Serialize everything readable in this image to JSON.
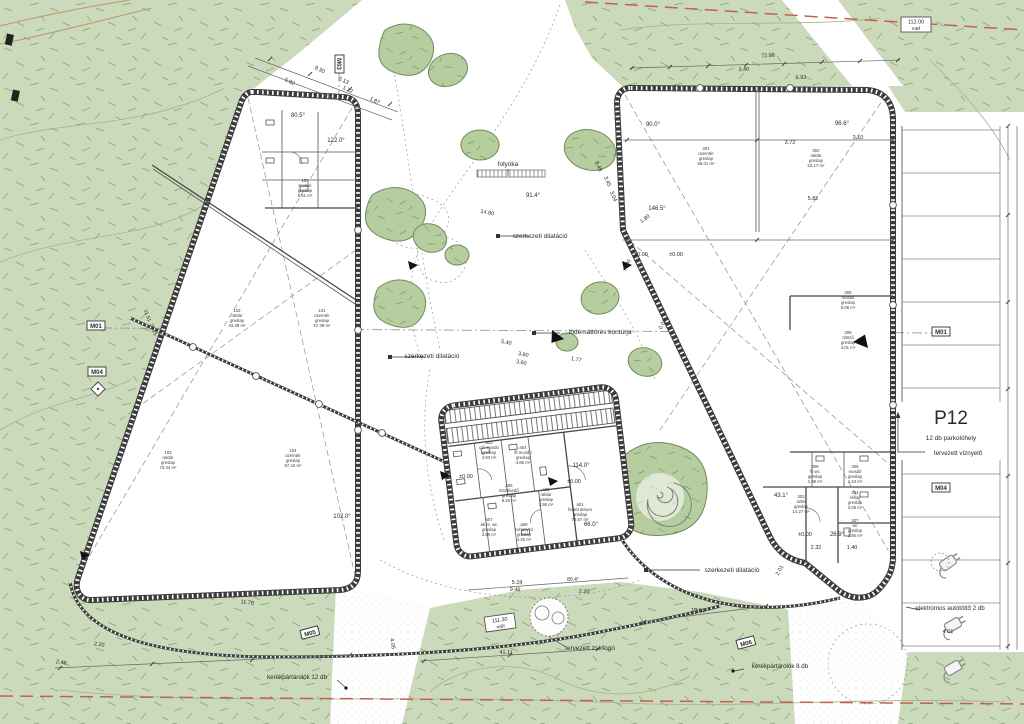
{
  "drawing_type": "architectural site plan",
  "colors": {
    "vegetation": "#cbdaba",
    "tree": "#b5cd9f",
    "vegetation_line": "#86a374",
    "wall": "#3c3c3c",
    "boundary_red": "#c4614d",
    "utility_tan": "#b99d6d"
  },
  "parking": {
    "code": "P12",
    "subtitle": "12 db parkolóhely",
    "stalls": 12,
    "x": 951,
    "y": 424
  },
  "markers": [
    {
      "label": "M01",
      "x": 96,
      "y": 326,
      "r": 0
    },
    {
      "label": "M04",
      "x": 97,
      "y": 372,
      "r": 0
    },
    {
      "label": "M03",
      "x": 339,
      "y": 64,
      "r": 90
    },
    {
      "label": "M01",
      "x": 941,
      "y": 332,
      "r": 0
    },
    {
      "label": "M04",
      "x": 941,
      "y": 488,
      "r": 0
    },
    {
      "label": "M05",
      "x": 310,
      "y": 633,
      "r": -15
    },
    {
      "label": "M06",
      "x": 746,
      "y": 643,
      "r": -15
    }
  ],
  "elevation_markers": [
    {
      "value": "112.00",
      "unit": "mBf",
      "x": 916,
      "y": 24,
      "r": 0
    },
    {
      "value": "111.30",
      "unit": "mBf",
      "x": 500,
      "y": 622,
      "r": -8
    }
  ],
  "rooms": [
    {
      "id": "101",
      "name": "üzemtér",
      "finish": "greslap",
      "area": "57.38 m²",
      "x": 322,
      "y": 312
    },
    {
      "id": "102",
      "name": "raktár",
      "finish": "greslap",
      "area": "43.39 m²",
      "x": 237,
      "y": 312
    },
    {
      "id": "103",
      "name": "raktár",
      "finish": "greslap",
      "area": "73.44 m²",
      "x": 168,
      "y": 454
    },
    {
      "id": "104",
      "name": "üzemtér",
      "finish": "greslap",
      "area": "57.42 m²",
      "x": 293,
      "y": 452
    },
    {
      "id": "105",
      "name": "mosdó",
      "finish": "greslap",
      "area": "9.51 m²",
      "x": 305,
      "y": 182
    },
    {
      "id": "301",
      "name": "üzemtér",
      "finish": "greslap",
      "area": "66.01 m²",
      "x": 706,
      "y": 150
    },
    {
      "id": "302",
      "name": "raktár",
      "finish": "greslap",
      "area": "52.17 m²",
      "x": 816,
      "y": 152
    },
    {
      "id": "303",
      "name": "üzlet",
      "finish": "greslap",
      "area": "14.27 m²",
      "x": 801,
      "y": 498
    },
    {
      "id": "304",
      "name": "előtér",
      "finish": "greslap",
      "area": "2.08 m²",
      "x": 855,
      "y": 494
    },
    {
      "id": "305",
      "name": "mosdó",
      "finish": "greslap",
      "area": "1.43 m²",
      "x": 855,
      "y": 468
    },
    {
      "id": "306",
      "name": "ffi wc",
      "finish": "greslap",
      "area": "1.98 m²",
      "x": 815,
      "y": 468
    },
    {
      "id": "307",
      "name": "wc",
      "finish": "greslap",
      "area": "1.56 m²",
      "x": 855,
      "y": 522
    },
    {
      "id": "308",
      "name": "mosdó",
      "finish": "greslap",
      "area": "5.08 m²",
      "x": 848,
      "y": 294
    },
    {
      "id": "309",
      "name": "öltöző",
      "finish": "greslap",
      "area": "4.01 m²",
      "x": 848,
      "y": 334
    },
    {
      "id": "a03",
      "name": "női mosdó",
      "finish": "greslap",
      "area": "4.93 m²",
      "x": 489,
      "y": 444
    },
    {
      "id": "a04",
      "name": "ffi mosdó",
      "finish": "greslap",
      "area": "4.86 m²",
      "x": 523,
      "y": 449
    },
    {
      "id": "a05",
      "name": "közlekedő",
      "finish": "greslap",
      "area": "8.26 m²",
      "x": 509,
      "y": 487
    },
    {
      "id": "a06",
      "name": "raktár",
      "finish": "greslap",
      "area": "2.95 m²",
      "x": 546,
      "y": 491
    },
    {
      "id": "a07",
      "name": "ak.m. wc",
      "finish": "greslap",
      "area": "3.89 m²",
      "x": 489,
      "y": 521
    },
    {
      "id": "a08",
      "name": "zuhanyzó",
      "finish": "greslap",
      "area": "4.25 m²",
      "x": 524,
      "y": 526
    },
    {
      "id": "a01",
      "name": "fedett átrium",
      "finish": "greslap",
      "area": "73.67 m²",
      "x": 580,
      "y": 506
    }
  ],
  "annotations": [
    {
      "t": "folyóka",
      "x": 508,
      "y": 166,
      "s": 6.5,
      "n": "callout-folyoka"
    },
    {
      "t": "szerkezeti dilatáció",
      "x": 540,
      "y": 238,
      "s": 6.5,
      "n": "callout-dilatacio-1"
    },
    {
      "t": "szerkezeti dilatáció",
      "x": 432,
      "y": 358,
      "s": 6.5,
      "n": "callout-dilatacio-2"
    },
    {
      "t": "szerkezeti dilatáció",
      "x": 732,
      "y": 572,
      "s": 6.5,
      "n": "callout-dilatacio-3"
    },
    {
      "t": "födémáttörés kontúrja",
      "x": 600,
      "y": 334,
      "s": 6.5,
      "n": "callout-fodem"
    },
    {
      "t": "tervezett zsírfogó",
      "x": 590,
      "y": 650,
      "s": 6.5,
      "n": "callout-zsirfogo"
    },
    {
      "t": "tervezett víznyelő",
      "x": 958,
      "y": 455,
      "s": 6.2,
      "n": "callout-viznyelo"
    },
    {
      "t": "elektromos autótöltő 2 db",
      "x": 950,
      "y": 610,
      "s": 6.2,
      "n": "callout-autotolto"
    },
    {
      "t": "kerékpártárolók 12 db",
      "x": 297,
      "y": 679,
      "s": 6.2,
      "n": "callout-kerekpar-12"
    },
    {
      "t": "kerékpártárolók 8 db",
      "x": 780,
      "y": 668,
      "s": 6.2,
      "n": "callout-kerekpar-8"
    },
    {
      "t": "72.98",
      "x": 768,
      "y": 57,
      "r": -3
    },
    {
      "t": "3.40",
      "x": 744,
      "y": 71,
      "r": -3
    },
    {
      "t": "6.93",
      "x": 801,
      "y": 79,
      "r": -3
    },
    {
      "t": "9.30",
      "x": 319,
      "y": 71,
      "r": 27
    },
    {
      "t": "5.92",
      "x": 289,
      "y": 83,
      "r": 27
    },
    {
      "t": "5.13",
      "x": 343,
      "y": 82,
      "r": 27
    },
    {
      "t": "1.22",
      "x": 347,
      "y": 91,
      "r": 27
    },
    {
      "t": "1.87",
      "x": 374,
      "y": 102,
      "r": 27
    },
    {
      "t": "3.72",
      "x": 790,
      "y": 144
    },
    {
      "t": "5.82",
      "x": 813,
      "y": 200
    },
    {
      "t": "3.10",
      "x": 858,
      "y": 139
    },
    {
      "t": "14.80",
      "x": 487,
      "y": 214,
      "r": 12
    },
    {
      "t": "8.48",
      "x": 597,
      "y": 167,
      "r": 66
    },
    {
      "t": "3.45",
      "x": 606,
      "y": 182,
      "r": 66
    },
    {
      "t": "3.04",
      "x": 612,
      "y": 197,
      "r": 66
    },
    {
      "t": "5.40",
      "x": 506,
      "y": 344,
      "r": 11
    },
    {
      "t": "3.60",
      "x": 523,
      "y": 356,
      "r": 11
    },
    {
      "t": "3.60",
      "x": 521,
      "y": 364,
      "r": 11
    },
    {
      "t": "1.77",
      "x": 576,
      "y": 361,
      "r": 11
    },
    {
      "t": "0.02",
      "x": 664,
      "y": 325,
      "r": -62
    },
    {
      "t": "2.01",
      "x": 781,
      "y": 571,
      "r": -62
    },
    {
      "t": "10.91",
      "x": 698,
      "y": 612,
      "r": 3
    },
    {
      "t": "41.11",
      "x": 506,
      "y": 654,
      "r": 2
    },
    {
      "t": "5.28",
      "x": 517,
      "y": 584,
      "r": 3
    },
    {
      "t": "9.46",
      "x": 515,
      "y": 591,
      "r": 3
    },
    {
      "t": "2.20",
      "x": 584,
      "y": 593,
      "r": 3
    },
    {
      "t": "11.78",
      "x": 247,
      "y": 604,
      "r": 8
    },
    {
      "t": "2.20",
      "x": 99,
      "y": 646,
      "r": 8
    },
    {
      "t": "2.46",
      "x": 61,
      "y": 664,
      "r": 8
    },
    {
      "t": "4.05",
      "x": 391,
      "y": 644,
      "r": 80
    },
    {
      "t": "4.01",
      "x": 948,
      "y": 633,
      "r": 3
    },
    {
      "t": "2.32",
      "x": 816,
      "y": 549
    },
    {
      "t": "1.40",
      "x": 852,
      "y": 549
    },
    {
      "t": "21.51",
      "x": 146,
      "y": 316,
      "r": 68,
      "s": 5
    },
    {
      "t": "20.15",
      "x": 152,
      "y": 330,
      "r": 68,
      "s": 5
    },
    {
      "t": "1.80",
      "x": 646,
      "y": 220,
      "r": -38
    },
    {
      "t": "80.5°",
      "x": 298,
      "y": 117,
      "s": 6,
      "n": "angle-label"
    },
    {
      "t": "122.0°",
      "x": 336,
      "y": 142,
      "s": 6,
      "n": "angle-label"
    },
    {
      "t": "90.0°",
      "x": 653,
      "y": 126,
      "s": 6,
      "n": "angle-label"
    },
    {
      "t": "96.6°",
      "x": 842,
      "y": 125,
      "s": 6,
      "n": "angle-label"
    },
    {
      "t": "146.5°",
      "x": 657,
      "y": 210,
      "s": 6,
      "n": "angle-label"
    },
    {
      "t": "91.4°",
      "x": 533,
      "y": 197,
      "s": 6,
      "n": "angle-label"
    },
    {
      "t": "114.0°",
      "x": 581,
      "y": 467,
      "s": 6,
      "n": "angle-label"
    },
    {
      "t": "66.0°",
      "x": 591,
      "y": 526,
      "s": 6,
      "n": "angle-label"
    },
    {
      "t": "102.0°",
      "x": 342,
      "y": 518,
      "s": 6,
      "n": "angle-label"
    },
    {
      "t": "43.1°",
      "x": 781,
      "y": 497,
      "s": 6,
      "n": "angle-label"
    },
    {
      "t": "26.9°",
      "x": 837,
      "y": 536,
      "s": 6,
      "n": "angle-label"
    },
    {
      "t": "80.4°",
      "x": 573,
      "y": 581,
      "s": 5,
      "n": "angle-label"
    },
    {
      "t": "±0.00",
      "x": 641,
      "y": 256,
      "n": "level-label"
    },
    {
      "t": "±0.00",
      "x": 676,
      "y": 256,
      "n": "level-label"
    },
    {
      "t": "±0.00",
      "x": 466,
      "y": 478,
      "n": "level-label"
    },
    {
      "t": "±0.00",
      "x": 574,
      "y": 483,
      "n": "level-label"
    },
    {
      "t": "±0.00",
      "x": 805,
      "y": 536,
      "n": "level-label"
    },
    {
      "t": "±0.00",
      "x": 628,
      "y": 266,
      "r": -62,
      "s": 5,
      "n": "level-label"
    }
  ]
}
